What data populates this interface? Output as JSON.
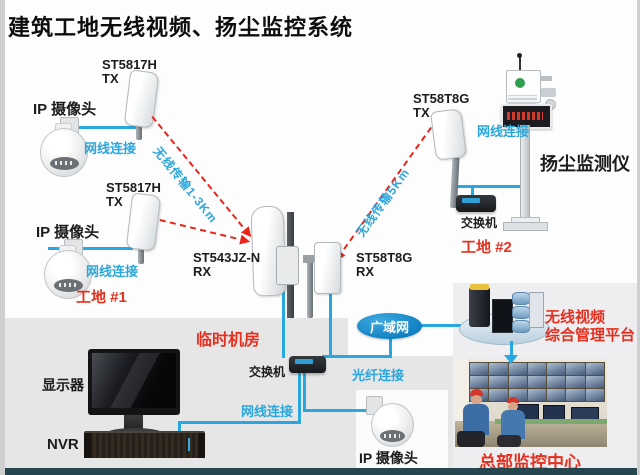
{
  "title": "建筑工地无线视频、扬尘监控系统",
  "colors": {
    "line_blue": "#29a8e0",
    "label_blue": "#2ba6db",
    "accent_red": "#e5301f",
    "wan_ellipse_blue": "#0e86c8",
    "machine_room_gray": "#e6e6e6",
    "bottom_bar": "#26464f"
  },
  "site1": {
    "site_label": "工地 #1",
    "cameras": [
      {
        "label": "IP 摄像头"
      },
      {
        "label": "IP 摄像头"
      }
    ],
    "antennas": [
      {
        "model": "ST5817H",
        "port": "TX"
      },
      {
        "model": "ST5817H",
        "port": "TX"
      }
    ],
    "cable_labels": [
      "网线连接",
      "网线连接"
    ]
  },
  "site2": {
    "site_label": "工地 #2",
    "antenna": {
      "model": "ST58T8G",
      "port": "TX"
    },
    "cable_label": "网线连接",
    "dust_monitor_label": "扬尘监测仪",
    "switch_label": "交换机"
  },
  "wireless_links": [
    {
      "label": "无线传输1-3Km"
    },
    {
      "label": "无线传输5Km"
    }
  ],
  "receivers": [
    {
      "model": "ST543JZ-N",
      "port": "RX"
    },
    {
      "model": "ST58T8G",
      "port": "RX"
    }
  ],
  "machine_room": {
    "label": "临时机房",
    "switch_label": "交换机",
    "cable_label": "网线连接",
    "fiber_label": "光纤连接",
    "monitor_label": "显示器",
    "nvr_label": "NVR",
    "camera_label": "IP 摄像头"
  },
  "wan": {
    "label": "广域网"
  },
  "platform": {
    "line1": "无线视频",
    "line2": "综合管理平台"
  },
  "hq": {
    "label": "总部监控中心"
  }
}
